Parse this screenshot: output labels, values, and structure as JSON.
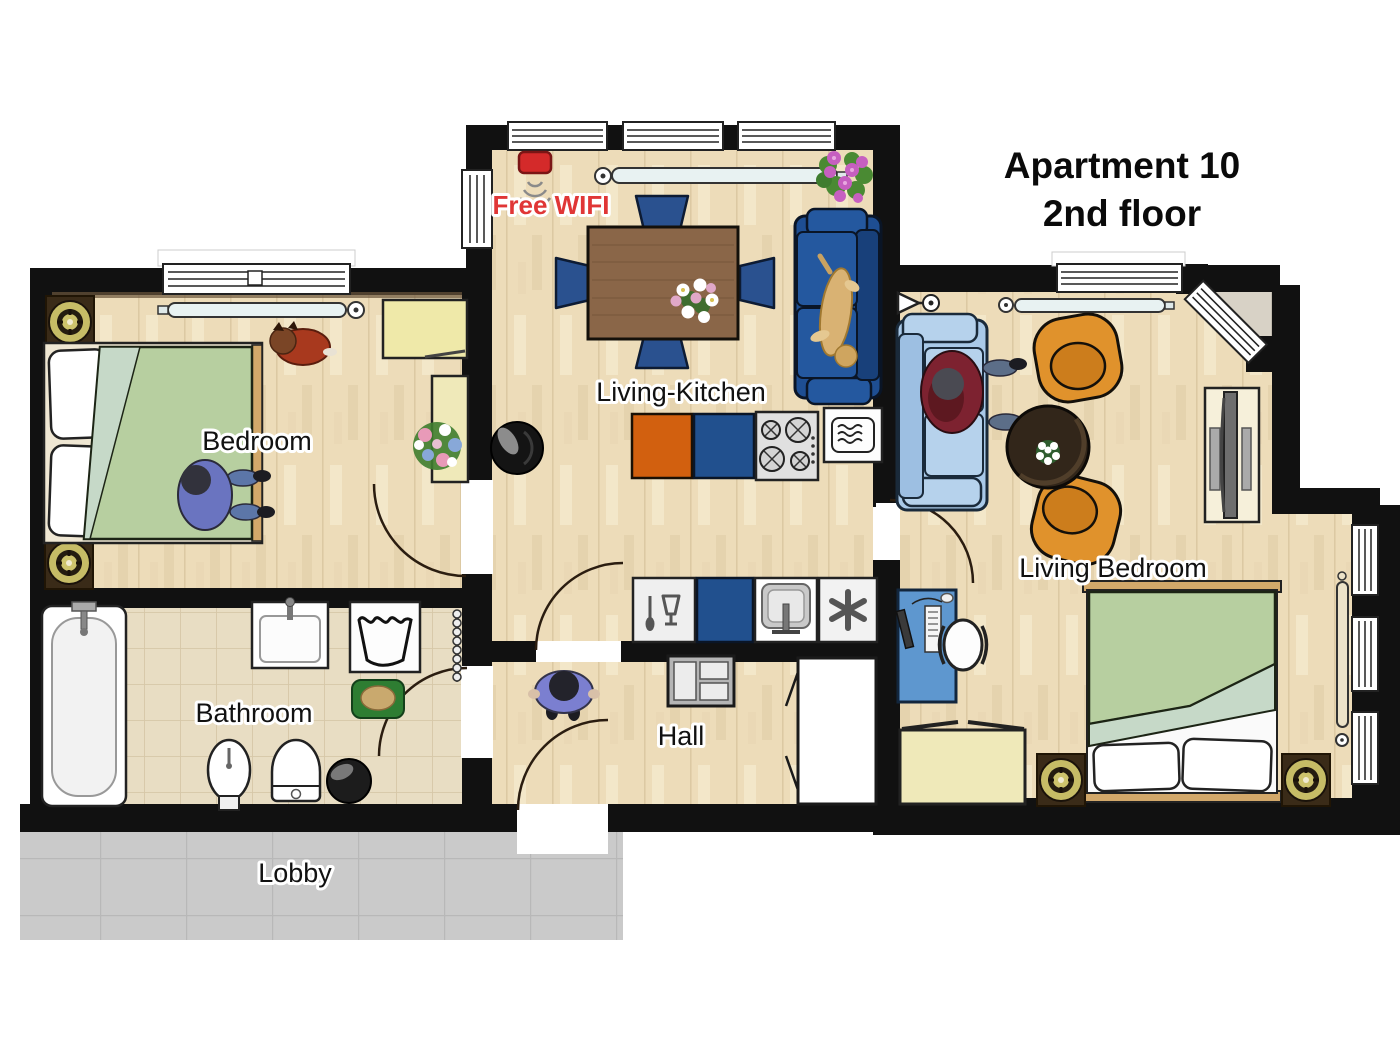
{
  "title": {
    "line1": "Apartment 10",
    "line2": "2nd floor"
  },
  "wifi": {
    "label": "Free WIFI"
  },
  "rooms": {
    "living_kitchen": {
      "label": "Living-Kitchen"
    },
    "bedroom": {
      "label": "Bedroom"
    },
    "bathroom": {
      "label": "Bathroom"
    },
    "hall": {
      "label": "Hall"
    },
    "living_bedroom": {
      "label": "Living Bedroom"
    },
    "lobby": {
      "label": "Lobby"
    }
  },
  "icons": {
    "wifi_router": "wifi-waves",
    "freezer": "snowflake-asterisk",
    "dishwasher": "spoon-and-glass",
    "washing_machine": "laundry-tub",
    "microwave": "micro-waves",
    "sink": "basin-faucet",
    "stove": "four-burners"
  },
  "colors": {
    "wall": "#111111",
    "wood_floor": "#eddcb9",
    "bath_tile": "#e8ddc3",
    "lobby_tile": "#cacaca",
    "balcony": "#d8d2c6",
    "kitchen_orange": "#d2600f",
    "kitchen_blue": "#21508e",
    "sofa_dark_blue": "#1e4e92",
    "sofa_light_blue": "#a9c9e8",
    "armchair_orange": "#e0922c",
    "bed_green": "#b7cfa0",
    "desk_blue": "#5e97cf",
    "furniture_cream": "#efe9b9",
    "wifi_red": "#e03636"
  }
}
